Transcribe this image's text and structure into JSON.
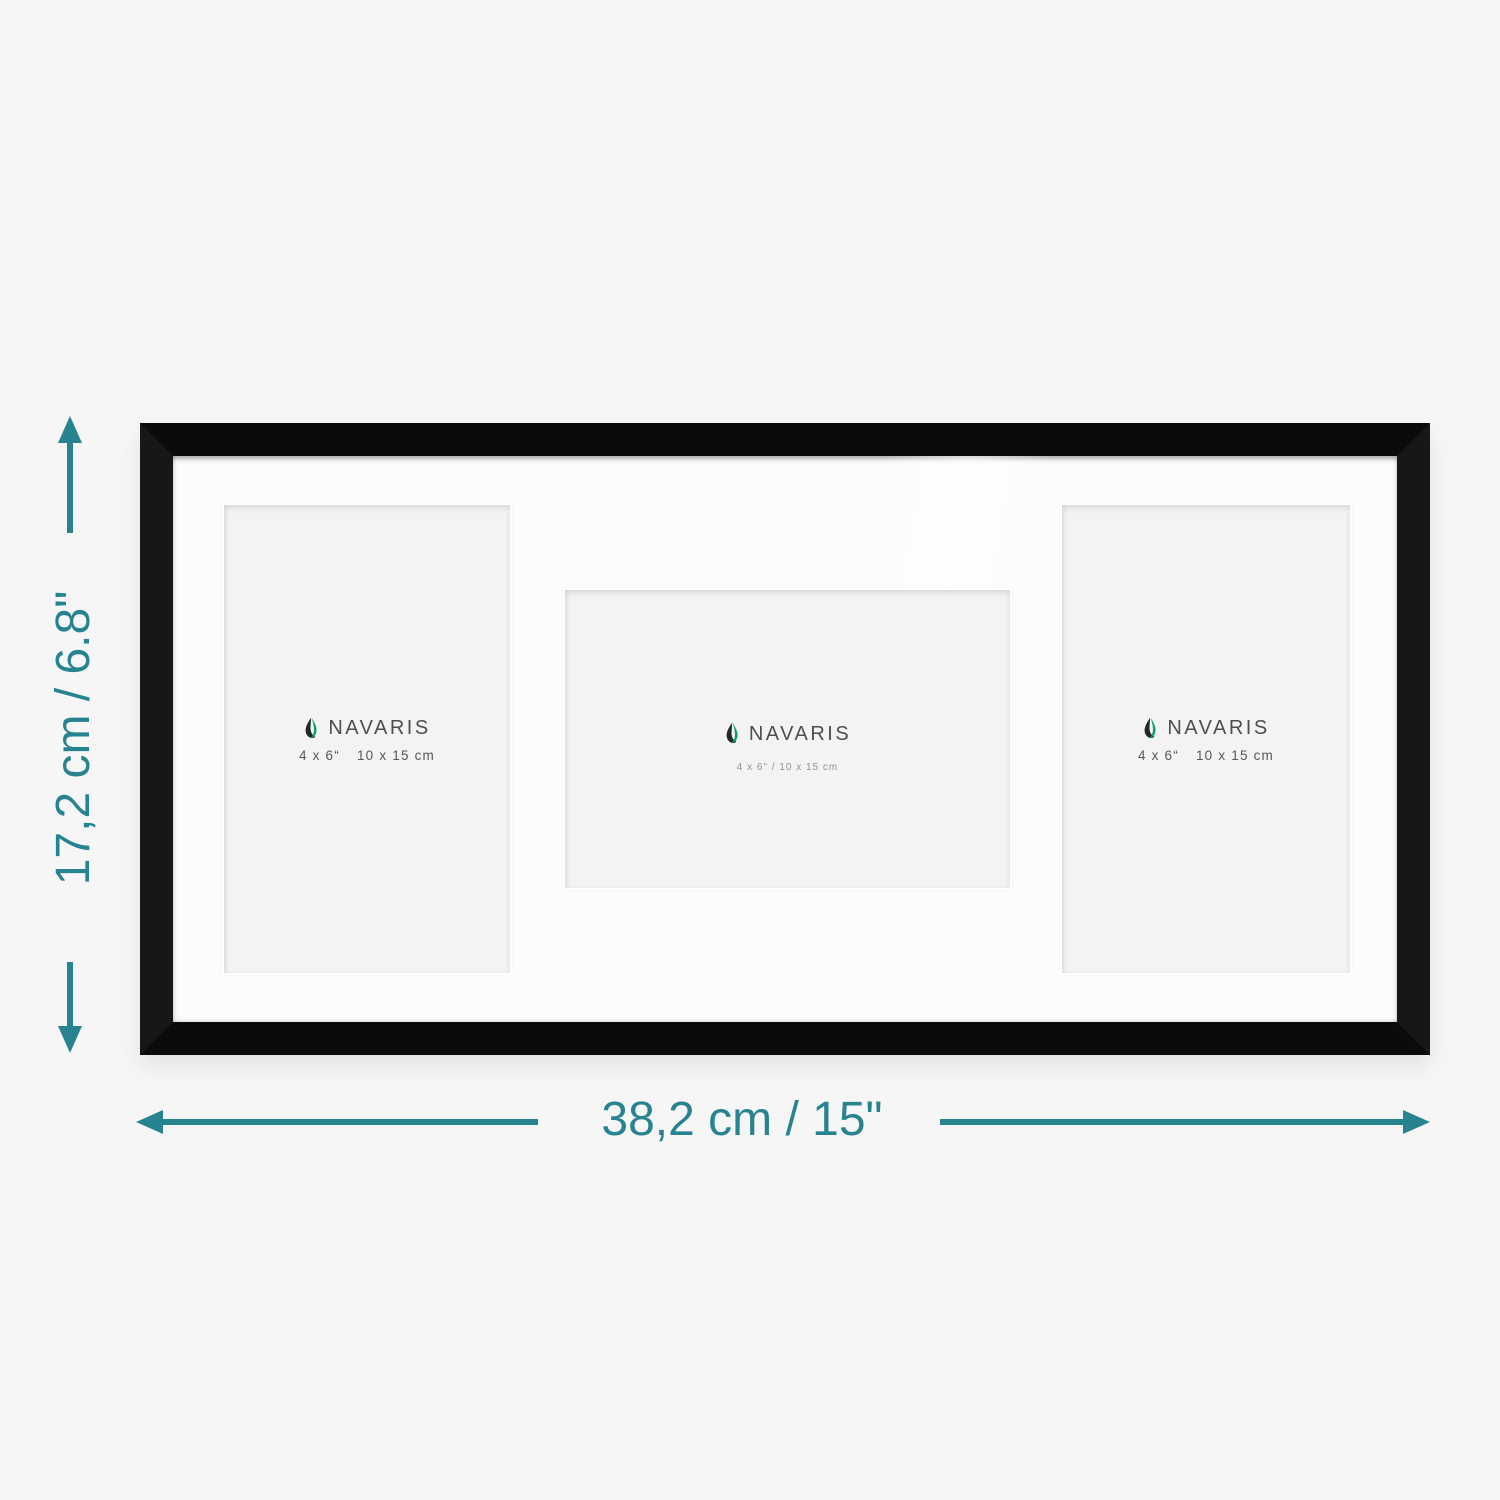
{
  "scene": {
    "background_color": "#f6f6f6",
    "description": "Navaris triple collage picture frame with dimension annotations"
  },
  "dimensions": {
    "accent_color": "#27838f",
    "height_label": "17,2 cm / 6.8\"",
    "width_label": "38,2 cm / 15\""
  },
  "frame": {
    "frame_color": "#0b0b0b",
    "mat_color": "#fcfcfc",
    "logo_colors": {
      "dark": "#23272b",
      "green": "#0b9f6b"
    },
    "openings": [
      {
        "position": "left",
        "orientation": "portrait",
        "brand": "NAVARIS",
        "size_inches": "4 x 6“",
        "size_cm": "10 x 15 cm"
      },
      {
        "position": "center",
        "orientation": "landscape",
        "brand": "NAVARIS",
        "size_label": "4 x 6\" / 10 x 15 cm"
      },
      {
        "position": "right",
        "orientation": "portrait",
        "brand": "NAVARIS",
        "size_inches": "4 x 6“",
        "size_cm": "10 x 15 cm"
      }
    ]
  }
}
